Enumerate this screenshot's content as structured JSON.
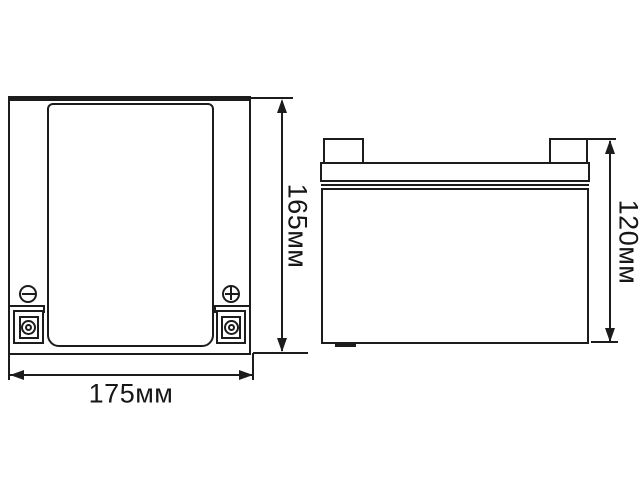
{
  "page": {
    "background_color": "#ffffff",
    "line_color": "#1c1c1c"
  },
  "diagram": {
    "type": "technical-dimension-drawing",
    "subject": "sealed battery, front view and side view with overall dimensions",
    "front_view": {
      "width_label": "175мм",
      "height_label": "165мм",
      "icons": {
        "negative_terminal": "minus-screw-icon",
        "positive_terminal": "plus-screw-icon",
        "mounting_bushings": "ring-bushing-icon"
      }
    },
    "side_view": {
      "height_label": "120мм"
    }
  }
}
